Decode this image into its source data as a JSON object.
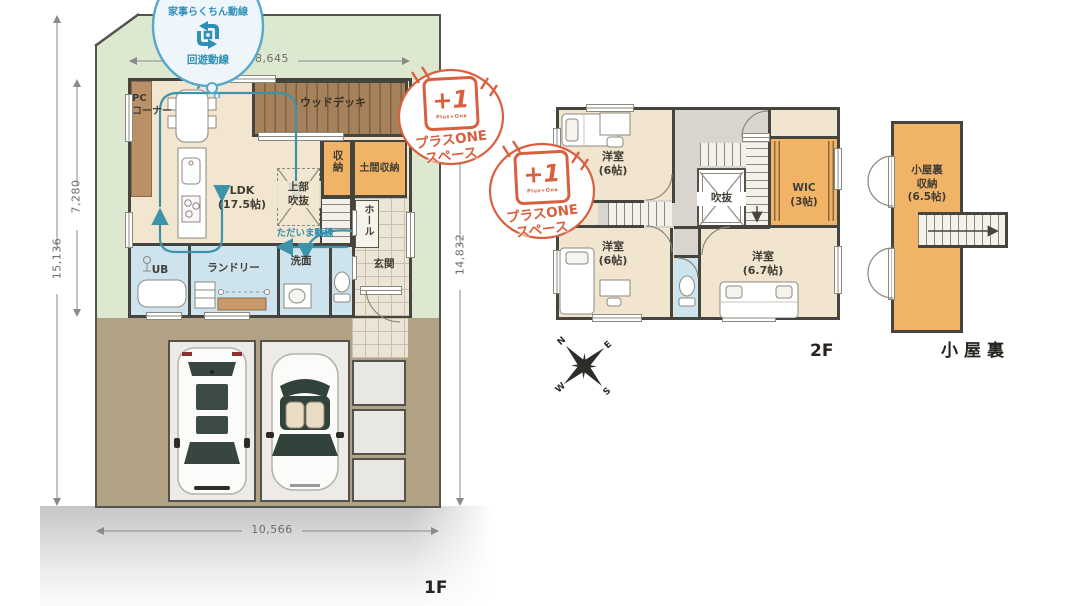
{
  "bubble": {
    "title": "家事らくちん動線",
    "label": "回遊動線"
  },
  "badge": {
    "big": "+1",
    "small": "Plus+One",
    "line1": "プラスONE",
    "line2": "スペース"
  },
  "floor1": {
    "name": "1F",
    "flow": "ただいま動線",
    "dims": {
      "top": "8,645",
      "left_inner": "7,280",
      "left_outer": "15,136",
      "right": "14,832",
      "bottom": "10,566"
    },
    "rooms": {
      "pc_corner": "PC\nコーナー",
      "wood_deck": "ウッドデッキ",
      "closet": "収納",
      "doma_storage": "土間収納",
      "ldk": "LDK\n(17.5帖)",
      "upper_void": "上部\n吹抜",
      "hall": "ホール",
      "entrance": "玄関",
      "washroom": "洗面",
      "laundry": "ランドリー",
      "bath": "UB"
    }
  },
  "floor2": {
    "name": "2F",
    "rooms": {
      "bedroom_a": "洋室\n(6帖)",
      "bedroom_b": "洋室\n(6帖)",
      "bedroom_c": "洋室\n(6.7帖)",
      "wic": "WIC\n(3帖)",
      "void": "吹抜"
    }
  },
  "attic": {
    "name": "小屋裏",
    "rooms": {
      "storage": "小屋裏\n収納\n(6.5帖)"
    }
  },
  "compass": {
    "n": "N",
    "e": "E",
    "s": "S",
    "w": "W"
  },
  "icons": {
    "circulation": "loop-arrows-icon",
    "compass": "compass-rose-icon",
    "cars": [
      "wagon-top-view-icon",
      "convertible-top-view-icon"
    ]
  },
  "colors": {
    "wall": "#45443f",
    "yard_green": "#dce8cf",
    "floor_beige": "#f2e6d0",
    "storage_orange": "#f1b366",
    "wet_blue": "#cde4ee",
    "garage_taupe": "#b1a286",
    "deck_brown": "#a5815c",
    "accent_teal": "#3d93a8",
    "badge_orange": "#d9603f"
  }
}
